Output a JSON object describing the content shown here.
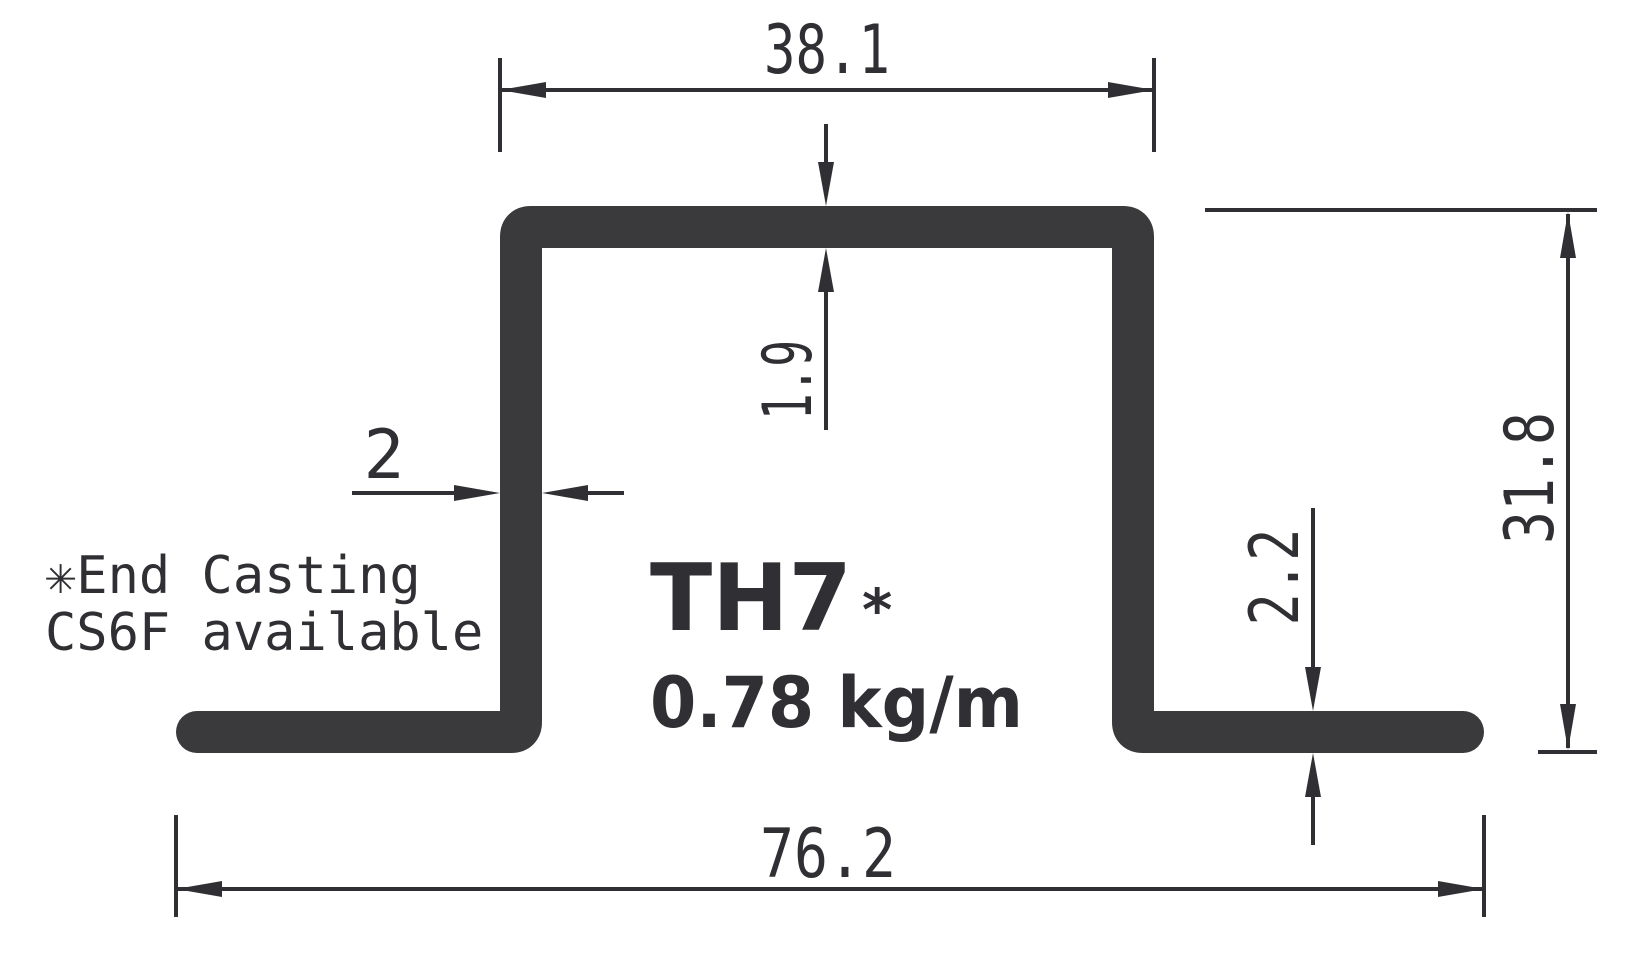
{
  "drawing": {
    "part_label": "TH7",
    "part_label_marker": "*",
    "weight_per_meter": "0.78 kg/m",
    "note": {
      "line1": "✳End Casting",
      "line2": "CS6F available"
    },
    "dimensions": {
      "top_width": "38.1",
      "top_wall_thickness": "1.9",
      "side_wall_thickness": "2",
      "flange_thickness": "2.2",
      "overall_height": "31.8",
      "overall_width": "76.2"
    },
    "colors": {
      "ink": "#303034",
      "profile": "#3a3a3d",
      "background": "#ffffff"
    }
  }
}
